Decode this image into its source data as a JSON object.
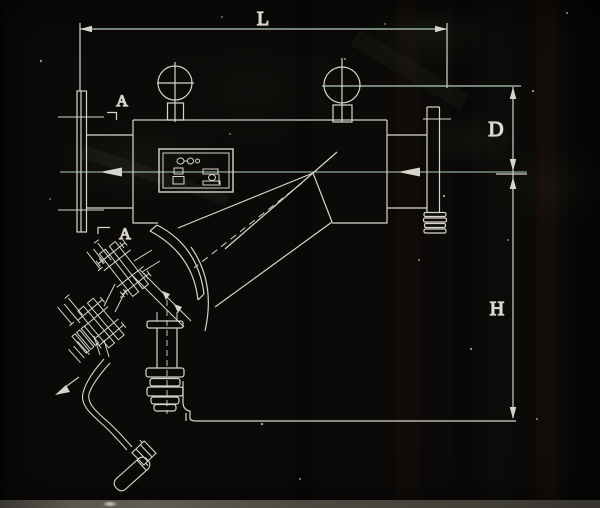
{
  "drawing": {
    "labels": {
      "length": "L",
      "section_top": "A",
      "section_bottom": "A",
      "diameter": "D",
      "height": "H"
    },
    "colors": {
      "background": "#0b0a08",
      "line": "#d7d5cb",
      "tinted_line": "#b4cfc0",
      "label_text": "#eae8df",
      "scan_strip": "#57534b"
    }
  }
}
